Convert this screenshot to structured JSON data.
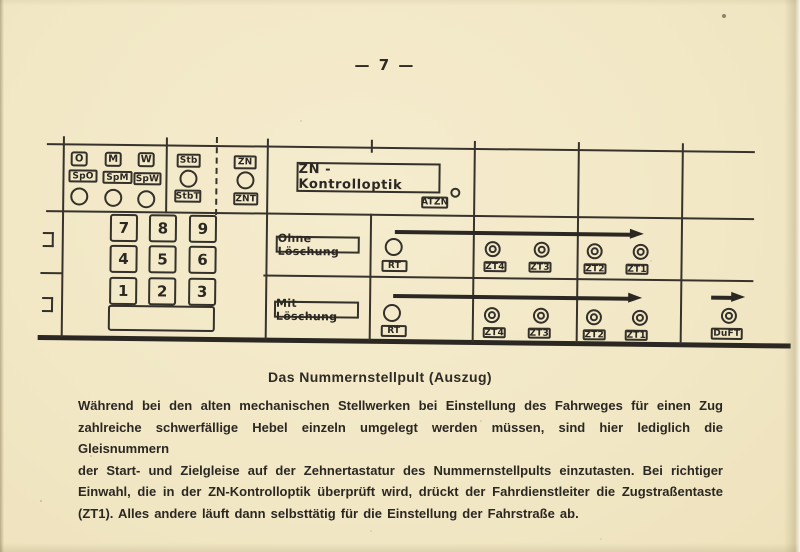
{
  "page": {
    "number_label": "— 7 —",
    "caption": "Das Nummernstellpult (Auszug)",
    "paragraph_lines": [
      "Während bei den alten mechanischen Stellwerken bei Einstellung des Fahrweges für einen Zug",
      "zahlreiche schwerfällige Hebel einzeln umgelegt werden müssen, sind hier lediglich die Gleisnummern",
      "der Start- und Zielgleise auf der Zehnertastatur des Nummernstellpults einzutasten. Bei richtiger",
      "Einwahl, die in der ZN-Kontrolloptik überprüft wird, drückt der Fahrdienstleiter die Zugstraßentaste",
      "(ZT1). Alles andere läuft dann selbsttätig für die Einstellung der Fahrstraße ab."
    ]
  },
  "panel": {
    "top_row": {
      "buttons": [
        "O",
        "M",
        "W"
      ],
      "sp_buttons": [
        "SpO",
        "SpM",
        "SpW"
      ],
      "stb_button": "Stb",
      "stbt_button": "StbT",
      "zn_button": "ZN",
      "znt_button": "ZNT",
      "kontrolloptik_label": "ZN - Kontrolloptik",
      "atzn_label": "ATZN"
    },
    "keypad": {
      "rows": [
        [
          "7",
          "8",
          "9"
        ],
        [
          "4",
          "5",
          "6"
        ],
        [
          "1",
          "2",
          "3"
        ]
      ]
    },
    "row_ohne": {
      "label": "Ohne Löschung",
      "rt": "RT",
      "zt": [
        "ZT4",
        "ZT3",
        "ZT2",
        "ZT1"
      ]
    },
    "row_mit": {
      "label": "Mit Löschung",
      "rt": "RT",
      "zt": [
        "ZT4",
        "ZT3",
        "ZT2",
        "ZT1"
      ],
      "duft": "DuFT"
    }
  },
  "colors": {
    "paper": "#f2e8c6",
    "ink": "#2e2a24"
  }
}
